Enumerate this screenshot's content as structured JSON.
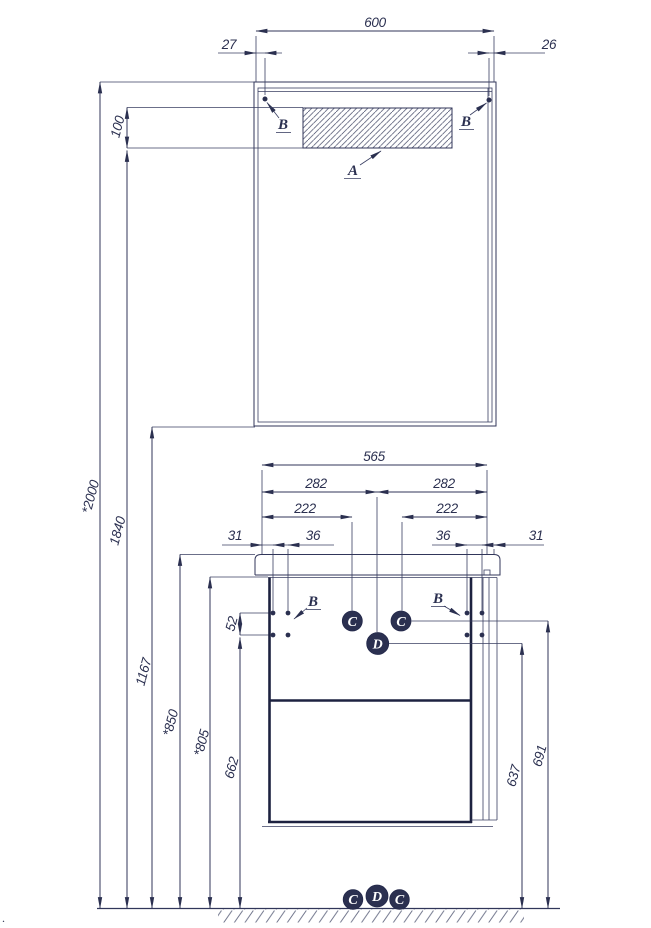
{
  "dims": {
    "mirror_width": "600",
    "offset_left": "27",
    "offset_right": "26",
    "lamp_height": "100",
    "total_height": "*2000",
    "lamp_mount_height": "1840",
    "mirror_bottom_height": "1167",
    "countertop_height": "*850",
    "body_top_height": "*805",
    "side_hole_height": "662",
    "side_hole_gap": "52",
    "vanity_width": "565",
    "center_left": "282",
    "center_right": "282",
    "hole_span_left": "222",
    "hole_span_right": "222",
    "edge_gap_left": "31",
    "pair_gap_left": "36",
    "pair_gap_right": "36",
    "edge_gap_right": "31",
    "drain_height": "637",
    "outlet_height": "691"
  },
  "labels": {
    "lamp": "A",
    "mount_top_left": "B",
    "mount_top_right": "B",
    "mount_bottom_left": "B",
    "mount_bottom_right": "B",
    "marker_c_left": "C",
    "marker_c_right": "C",
    "marker_d": "D"
  },
  "ground_markers": {
    "left": "C",
    "center": "D",
    "right": "C"
  },
  "stray_mark": "."
}
